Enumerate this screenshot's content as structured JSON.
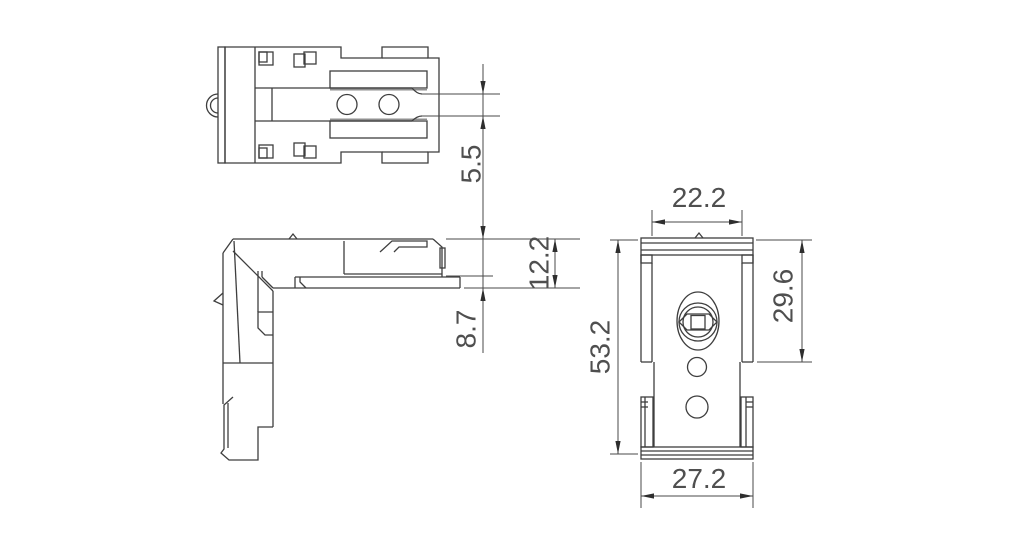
{
  "drawing": {
    "background": "#ffffff",
    "geometry_color": "#3e3e3e",
    "dimension_color": "#4a4a4a",
    "arrow_color": "#2e2e2e",
    "dimensions": {
      "tab_slot_height": {
        "value": "5.5"
      },
      "arm_overall_thickness": {
        "value": "12.2"
      },
      "arm_lower_offset": {
        "value": "8.7"
      },
      "body_width": {
        "value": "22.2"
      },
      "upper_section_height": {
        "value": "29.6"
      },
      "overall_height": {
        "value": "53.2"
      },
      "base_width": {
        "value": "27.2"
      }
    }
  }
}
